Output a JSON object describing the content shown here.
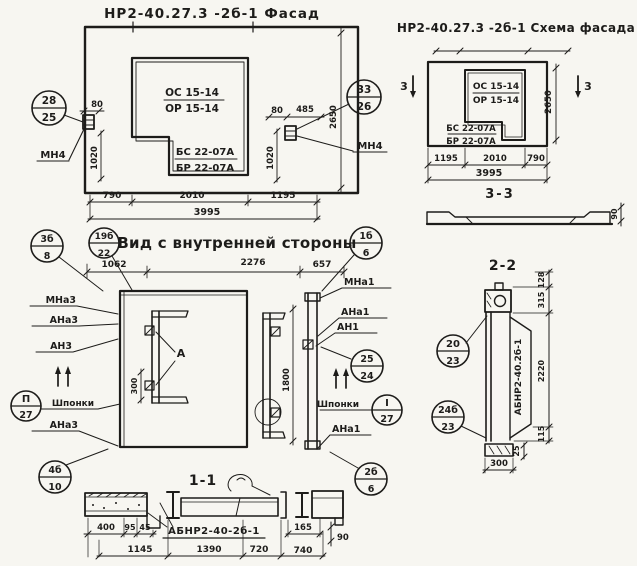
{
  "facade": {
    "title": "НР2-40.27.3 -2б-1 Фасад",
    "window_mark_top": "ОС 15-14",
    "window_mark_bottom": "ОР 15-14",
    "sill_mark_top": "БС 22-07А",
    "sill_mark_bottom": "БР 22-07А",
    "callout_left": {
      "top": "28",
      "bottom": "25"
    },
    "callout_right": {
      "top": "33",
      "bottom": "26"
    },
    "anchor_left": "МН4",
    "anchor_right": "МН4",
    "dim_80_left": "80",
    "dim_1020_left": "1020",
    "dim_80_right": "80",
    "dim_485": "485",
    "dim_1020_right": "1020",
    "dim_height": "2650",
    "dims_bottom": [
      "790",
      "2010",
      "1195"
    ],
    "dim_total": "3995"
  },
  "schema": {
    "title": "НР2-40.27.3 -2б-1 Схема фасада",
    "window_mark_top": "ОС 15-14",
    "window_mark_bottom": "ОР 15-14",
    "sill_mark_top": "БС 22-07А",
    "sill_mark_bottom": "БР 22-07А",
    "section_marker_left": "3",
    "section_marker_right": "3",
    "dim_height": "2650",
    "dims_bottom": [
      "1195",
      "2010",
      "790"
    ],
    "dim_total": "3995",
    "section_label": "3-3",
    "profile_thickness": "90"
  },
  "inner_view": {
    "title": "Вид с внутренней стороны",
    "dims_top": [
      "1062",
      "2276",
      "657"
    ],
    "labels_left": [
      "МНа3",
      "АНа3",
      "АН3",
      "Шпонки",
      "АНа3"
    ],
    "labels_right": [
      "МНа1",
      "АНа1",
      "АН1",
      "Шпонки",
      "АНа1"
    ],
    "callout_38": {
      "top": "3б",
      "bottom": "8"
    },
    "callout_1922": {
      "top": "19б",
      "bottom": "22"
    },
    "callout_16": {
      "top": "1б",
      "bottom": "6"
    },
    "callout_2524": {
      "top": "25",
      "bottom": "24"
    },
    "callout_p27": {
      "top": "П",
      "bottom": "27"
    },
    "callout_i27": {
      "top": "I",
      "bottom": "27"
    },
    "callout_4610": {
      "top": "4б",
      "bottom": "10"
    },
    "callout_266": {
      "top": "2б",
      "bottom": "6"
    },
    "detail_mark": "А",
    "dim_300": "300",
    "dim_1800": "1800"
  },
  "section_1_1": {
    "title": "1-1",
    "part_label": "АБНР2-40-2б-1",
    "dims_small": [
      "400",
      "95",
      "45"
    ],
    "dim_165": "165",
    "dim_90": "90",
    "dims_bottom": [
      "1145",
      "1390",
      "720",
      "740"
    ]
  },
  "section_2_2": {
    "title": "2-2",
    "part_label": "АБНР2-40.2б-1",
    "callout_2023": {
      "top": "20",
      "bottom": "23"
    },
    "callout_2423": {
      "top": "24б",
      "bottom": "23"
    },
    "dim_128": "128",
    "dim_315": "315",
    "dim_2220": "2220",
    "dim_115": "115",
    "dim_25": "25",
    "dim_300": "300"
  }
}
